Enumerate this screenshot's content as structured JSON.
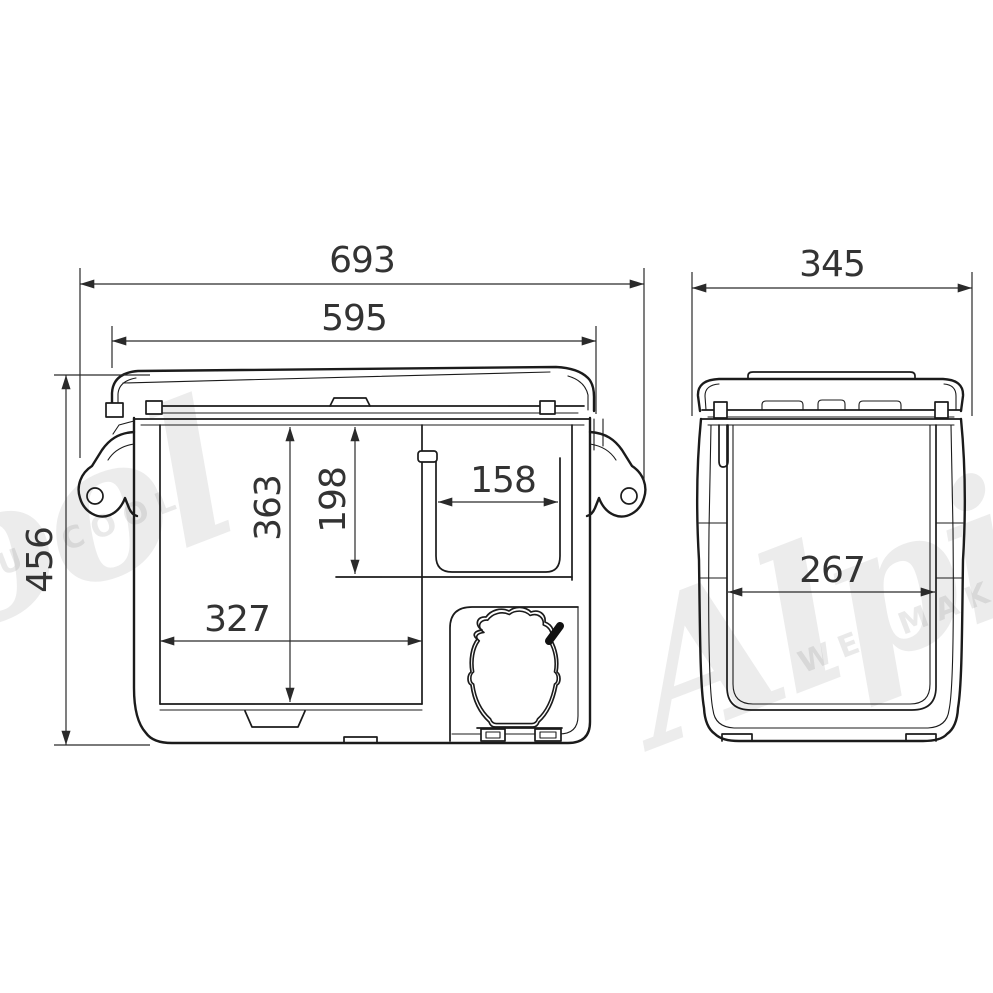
{
  "drawing": {
    "dimensions": {
      "front_overall_width": "693",
      "front_lid_width": "595",
      "side_overall_depth": "345",
      "overall_height": "456",
      "inner_depth_main": "363",
      "inner_depth_upper": "198",
      "basket_width": "158",
      "inner_width_main": "327",
      "side_inner_depth": "267"
    },
    "watermark": {
      "brand": "Alpicool",
      "tagline": "WE MAKE YOU COOL"
    }
  }
}
